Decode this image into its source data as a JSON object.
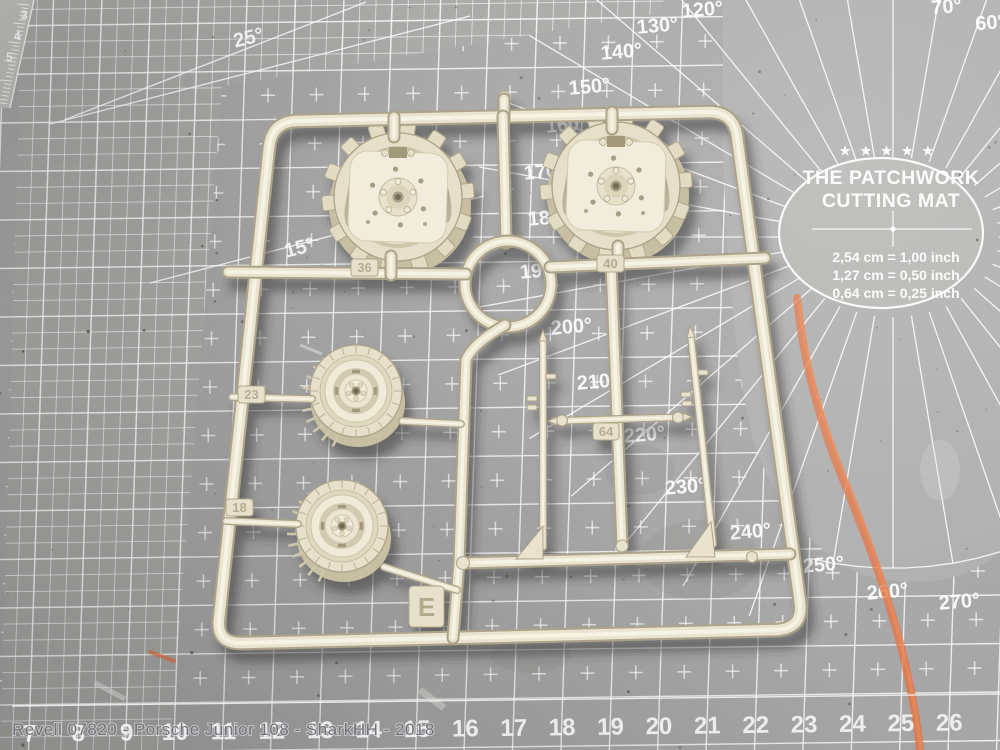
{
  "scene": {
    "caption": "Revell 07820 - Porsche Junior 108 - SharkHH - 2018"
  },
  "mat": {
    "brand_circle": {
      "stars": "★ ★ ★ ★ ★",
      "title_line1": "THE PATCHWORK",
      "title_line2": "CUTTING MAT",
      "conversions": [
        "2,54 cm = 1,00 inch",
        "1,27 cm = 0,50 inch",
        "0,64 cm = 0,25 inch"
      ]
    },
    "angle_labels": [
      {
        "text": "70°",
        "x": 947,
        "y": 13,
        "s": 18
      },
      {
        "text": "60°",
        "x": 991,
        "y": 29,
        "s": 18
      },
      {
        "text": "120°",
        "x": 703,
        "y": 16,
        "s": 20
      },
      {
        "text": "130°",
        "x": 658,
        "y": 32,
        "s": 20
      },
      {
        "text": "140°",
        "x": 622,
        "y": 58,
        "s": 20
      },
      {
        "text": "150°",
        "x": 590,
        "y": 93,
        "s": 20
      },
      {
        "text": "160°",
        "x": 567,
        "y": 131,
        "s": 20
      },
      {
        "text": "170°",
        "x": 545,
        "y": 178,
        "s": 20
      },
      {
        "text": "180°",
        "x": 549,
        "y": 224,
        "s": 20
      },
      {
        "text": "190°",
        "x": 541,
        "y": 277,
        "s": 20
      },
      {
        "text": "200°",
        "x": 572,
        "y": 333,
        "s": 20
      },
      {
        "text": "210°",
        "x": 598,
        "y": 388,
        "s": 20
      },
      {
        "text": "220°",
        "x": 645,
        "y": 441,
        "s": 20
      },
      {
        "text": "230°",
        "x": 686,
        "y": 493,
        "s": 20
      },
      {
        "text": "240°",
        "x": 751,
        "y": 538,
        "s": 20
      },
      {
        "text": "250°",
        "x": 824,
        "y": 571,
        "s": 20
      },
      {
        "text": "260°",
        "x": 888,
        "y": 598,
        "s": 20
      },
      {
        "text": "270°",
        "x": 960,
        "y": 608,
        "s": 20
      }
    ],
    "corner_angle_labels": [
      {
        "text": "25°",
        "x": 250,
        "y": 44
      },
      {
        "text": "15°",
        "x": 301,
        "y": 254
      }
    ],
    "left_ruler_numbers": [
      {
        "text": "3",
        "x": 21,
        "y": 19
      },
      {
        "text": "4",
        "x": 14,
        "y": 40
      },
      {
        "text": "5",
        "x": 6,
        "y": 61
      }
    ],
    "bottom_ruler_numbers": [
      "7",
      "8",
      "9",
      "10",
      "11",
      "12",
      "13",
      "14",
      "15",
      "16",
      "17",
      "18",
      "19",
      "20",
      "21",
      "22",
      "23",
      "24",
      "25",
      "26"
    ],
    "bottom_ruler": {
      "start_x": 30,
      "spacing": 48.4,
      "y": 742
    },
    "colors": {
      "base": "#a6a6a6",
      "plain_zone": "#aeaeae",
      "grid_line": "#ffffff",
      "chalk": "#e4713f",
      "sprue": "#e9e3cf"
    }
  },
  "sprue": {
    "tabs": [
      {
        "label": "36"
      },
      {
        "label": "40"
      },
      {
        "label": "23"
      },
      {
        "label": "18"
      },
      {
        "label": "64"
      },
      {
        "label": "E"
      }
    ]
  }
}
